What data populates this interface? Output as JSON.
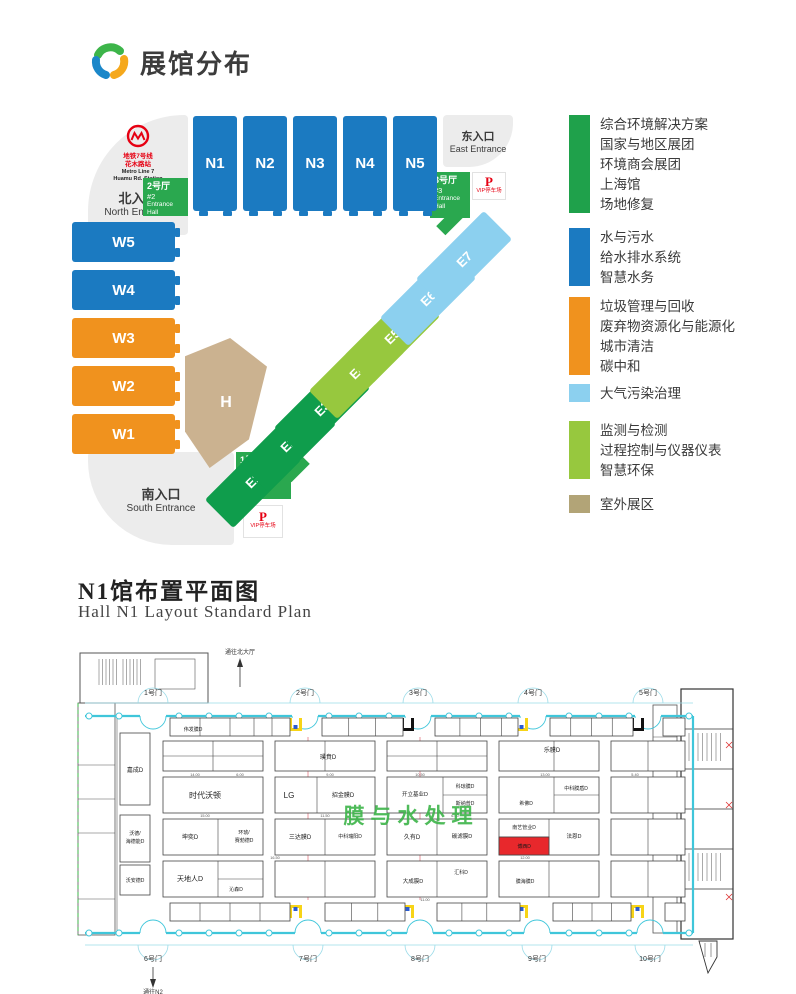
{
  "header": {
    "title": "展馆分布"
  },
  "site_map": {
    "north_entrance": {
      "metro_cn1": "地铁7号线",
      "metro_cn2": "花木路站",
      "metro_en1": "Metro Line 7",
      "metro_en2": "Huamu Rd. Station",
      "label_cn": "北入口",
      "label_en": "North Entrance"
    },
    "east_entrance": {
      "label_cn": "东入口",
      "label_en": "East Entrance"
    },
    "south_entrance": {
      "label_cn": "南入口",
      "label_en": "South Entrance"
    },
    "entrance_halls": [
      {
        "lines": [
          "2号厅",
          "#2",
          "Entrance Hall"
        ]
      },
      {
        "lines": [
          "3号厅",
          "#3",
          "Entrance Hall"
        ]
      },
      {
        "lines": [
          "1号厅",
          "#1",
          "Entrance Hall"
        ]
      }
    ],
    "parking": {
      "symbol": "P",
      "label": "VIP停车场"
    },
    "halls": [
      {
        "id": "N1",
        "x": 193,
        "y": 116,
        "w": 44,
        "h": 95,
        "color": "#1b7ac1",
        "stub": "b"
      },
      {
        "id": "N2",
        "x": 243,
        "y": 116,
        "w": 44,
        "h": 95,
        "color": "#1b7ac1",
        "stub": "b"
      },
      {
        "id": "N3",
        "x": 293,
        "y": 116,
        "w": 44,
        "h": 95,
        "color": "#1b7ac1",
        "stub": "b"
      },
      {
        "id": "N4",
        "x": 343,
        "y": 116,
        "w": 44,
        "h": 95,
        "color": "#1b7ac1",
        "stub": "b"
      },
      {
        "id": "N5",
        "x": 393,
        "y": 116,
        "w": 44,
        "h": 95,
        "color": "#1b7ac1",
        "stub": "b"
      },
      {
        "id": "W5",
        "x": 72,
        "y": 222,
        "w": 103,
        "h": 40,
        "color": "#1b7ac1",
        "stub": "r"
      },
      {
        "id": "W4",
        "x": 72,
        "y": 270,
        "w": 103,
        "h": 40,
        "color": "#1b7ac1",
        "stub": "r"
      },
      {
        "id": "W3",
        "x": 72,
        "y": 318,
        "w": 103,
        "h": 40,
        "color": "#f0921e",
        "stub": "r"
      },
      {
        "id": "W2",
        "x": 72,
        "y": 366,
        "w": 103,
        "h": 40,
        "color": "#f0921e",
        "stub": "r"
      },
      {
        "id": "W1",
        "x": 72,
        "y": 414,
        "w": 103,
        "h": 40,
        "color": "#f0921e",
        "stub": "r"
      },
      {
        "id": "E1",
        "cx": 253,
        "cy": 480,
        "rot": -45,
        "color": "#0f9d4c"
      },
      {
        "id": "E2",
        "cx": 288,
        "cy": 444,
        "rot": -45,
        "color": "#0f9d4c"
      },
      {
        "id": "E3",
        "cx": 322,
        "cy": 408,
        "rot": -45,
        "color": "#0f9d4c"
      },
      {
        "id": "E4",
        "cx": 357,
        "cy": 371,
        "rot": -45,
        "color": "#97c83e"
      },
      {
        "id": "E5",
        "cx": 392,
        "cy": 336,
        "rot": -45,
        "color": "#97c83e"
      },
      {
        "id": "E6",
        "cx": 428,
        "cy": 298,
        "rot": -45,
        "color": "#8cd0ef"
      },
      {
        "id": "E7",
        "cx": 464,
        "cy": 259,
        "rot": -45,
        "color": "#8cd0ef"
      },
      {
        "id": "H",
        "x": 185,
        "y": 338,
        "w": 82,
        "h": 130,
        "color": "#cbb290",
        "shape": "pent"
      }
    ]
  },
  "legend": {
    "groups": [
      {
        "color": "#1fa14b",
        "items": [
          "综合环境解决方案",
          "国家与地区展团",
          "环境商会展团",
          "上海馆",
          "场地修复"
        ]
      },
      {
        "color": "#1b7ac1",
        "items": [
          "水与污水",
          "给水排水系统",
          "智慧水务"
        ]
      },
      {
        "color": "#f0921e",
        "items": [
          "垃圾管理与回收",
          "废弃物资源化与能源化",
          "城市清洁",
          "碳中和"
        ]
      },
      {
        "color": "#8cd0ef",
        "items": [
          "大气污染治理"
        ]
      },
      {
        "color": "#97c83e",
        "items": [
          "监测与检测",
          "过程控制与仪器仪表",
          "智慧环保"
        ]
      },
      {
        "color": "#b2a477",
        "items": [
          "室外展区"
        ]
      }
    ]
  },
  "section": {
    "cn": "N1馆布置平面图",
    "en": "Hall N1 Layout Standard Plan"
  },
  "floor_plan": {
    "watermark": "膜与水处理",
    "to_north": "通往北大厅",
    "to_n2": "通往N2",
    "gates_top": [
      {
        "label": "1号门",
        "x": 78
      },
      {
        "label": "2号门",
        "x": 230
      },
      {
        "label": "3号门",
        "x": 343
      },
      {
        "label": "4号门",
        "x": 458
      },
      {
        "label": "5号门",
        "x": 573
      }
    ],
    "gates_bottom": [
      {
        "label": "6号门",
        "x": 78
      },
      {
        "label": "7号门",
        "x": 233
      },
      {
        "label": "8号门",
        "x": 345
      },
      {
        "label": "9号门",
        "x": 462
      },
      {
        "label": "10号门",
        "x": 575
      }
    ],
    "cells": [
      {
        "x": 95,
        "y": 73,
        "w": 120,
        "h": 18,
        "v": [
          0.25,
          0.5,
          0.7,
          0.85
        ]
      },
      {
        "x": 247,
        "y": 73,
        "w": 81,
        "h": 18,
        "v": [
          0.33,
          0.66
        ]
      },
      {
        "x": 360,
        "y": 73,
        "w": 83,
        "h": 18,
        "v": [
          0.3,
          0.55,
          0.8
        ]
      },
      {
        "x": 475,
        "y": 73,
        "w": 83,
        "h": 18,
        "v": [
          0.25,
          0.5,
          0.75
        ]
      },
      {
        "x": 588,
        "y": 73,
        "w": 22,
        "h": 18
      },
      {
        "x": 88,
        "y": 96,
        "w": 100,
        "h": 30,
        "v": [
          0.5
        ],
        "h2": [
          0.5
        ]
      },
      {
        "x": 200,
        "y": 96,
        "w": 100,
        "h": 30,
        "v": [
          0.5
        ]
      },
      {
        "x": 312,
        "y": 96,
        "w": 100,
        "h": 30,
        "v": [
          0.5
        ],
        "h2": [
          0.5
        ]
      },
      {
        "x": 424,
        "y": 96,
        "w": 100,
        "h": 30,
        "v": [
          0.55
        ]
      },
      {
        "x": 536,
        "y": 96,
        "w": 74,
        "h": 30,
        "v": [
          0.5
        ]
      },
      {
        "x": 88,
        "y": 132,
        "w": 100,
        "h": 36
      },
      {
        "x": 200,
        "y": 132,
        "w": 100,
        "h": 36,
        "v": [
          0.42
        ]
      },
      {
        "x": 312,
        "y": 132,
        "w": 100,
        "h": 36,
        "v": [
          0.56
        ],
        "hr": 1
      },
      {
        "x": 424,
        "y": 132,
        "w": 100,
        "h": 36,
        "v": [
          0.55
        ],
        "hr": 1
      },
      {
        "x": 536,
        "y": 132,
        "w": 74,
        "h": 36,
        "v": [
          0.5
        ]
      },
      {
        "x": 88,
        "y": 174,
        "w": 100,
        "h": 36,
        "v": [
          0.55
        ]
      },
      {
        "x": 200,
        "y": 174,
        "w": 100,
        "h": 36,
        "v": [
          0.5
        ]
      },
      {
        "x": 312,
        "y": 174,
        "w": 100,
        "h": 36,
        "v": [
          0.5
        ]
      },
      {
        "x": 424,
        "y": 174,
        "w": 100,
        "h": 36,
        "v": [
          0.5
        ],
        "hl": 1
      },
      {
        "x": 424,
        "y": 192,
        "w": 50,
        "h": 18,
        "fill": "#e8282c"
      },
      {
        "x": 536,
        "y": 174,
        "w": 74,
        "h": 36,
        "v": [
          0.5
        ]
      },
      {
        "x": 88,
        "y": 216,
        "w": 100,
        "h": 36,
        "v": [
          0.55
        ],
        "hr": 1
      },
      {
        "x": 200,
        "y": 216,
        "w": 100,
        "h": 36,
        "v": [
          0.5
        ]
      },
      {
        "x": 312,
        "y": 216,
        "w": 100,
        "h": 36,
        "v": [
          0.5
        ]
      },
      {
        "x": 424,
        "y": 216,
        "w": 100,
        "h": 36,
        "v": [
          0.5
        ]
      },
      {
        "x": 536,
        "y": 216,
        "w": 74,
        "h": 36,
        "v": [
          0.5
        ]
      },
      {
        "x": 95,
        "y": 258,
        "w": 120,
        "h": 18,
        "v": [
          0.25,
          0.5,
          0.75
        ]
      },
      {
        "x": 250,
        "y": 258,
        "w": 80,
        "h": 18,
        "v": [
          0.33,
          0.66
        ]
      },
      {
        "x": 362,
        "y": 258,
        "w": 83,
        "h": 18,
        "v": [
          0.3,
          0.6
        ]
      },
      {
        "x": 478,
        "y": 258,
        "w": 78,
        "h": 18,
        "v": [
          0.25,
          0.5,
          0.75
        ]
      },
      {
        "x": 590,
        "y": 258,
        "w": 20,
        "h": 18
      },
      {
        "x": 45,
        "y": 88,
        "w": 30,
        "h": 72
      },
      {
        "x": 45,
        "y": 170,
        "w": 30,
        "h": 47
      },
      {
        "x": 45,
        "y": 220,
        "w": 30,
        "h": 30
      }
    ],
    "labels": [
      {
        "t": "伟发膜D",
        "x": 118,
        "y": 86,
        "s": 5
      },
      {
        "t": "嘉成D",
        "x": 60,
        "y": 127,
        "s": 6
      },
      {
        "t": "沃德/",
        "x": 60,
        "y": 190,
        "s": 5
      },
      {
        "t": "海德能D",
        "x": 60,
        "y": 198,
        "s": 5
      },
      {
        "t": "沃安德D",
        "x": 60,
        "y": 237,
        "s": 5
      },
      {
        "t": "璞賁D",
        "x": 253,
        "y": 114,
        "s": 6
      },
      {
        "t": "乐膜D",
        "x": 477,
        "y": 107,
        "s": 6
      },
      {
        "t": "时代沃顿",
        "x": 130,
        "y": 153,
        "s": 8
      },
      {
        "t": "LG",
        "x": 214,
        "y": 153,
        "s": 8
      },
      {
        "t": "招金膜D",
        "x": 268,
        "y": 152,
        "s": 6
      },
      {
        "t": "开立基业D",
        "x": 340,
        "y": 151,
        "s": 5.5
      },
      {
        "t": "科琼膜D",
        "x": 390,
        "y": 143,
        "s": 5
      },
      {
        "t": "斯纳普D",
        "x": 390,
        "y": 160,
        "s": 5
      },
      {
        "t": "希佛D",
        "x": 451,
        "y": 160,
        "s": 5
      },
      {
        "t": "中科膜盾D",
        "x": 501,
        "y": 145,
        "s": 5
      },
      {
        "t": "坤奕D",
        "x": 115,
        "y": 194,
        "s": 6
      },
      {
        "t": "环琥/",
        "x": 169,
        "y": 189,
        "s": 5
      },
      {
        "t": "赛勃德D",
        "x": 169,
        "y": 197,
        "s": 5
      },
      {
        "t": "三达膜D",
        "x": 225,
        "y": 194,
        "s": 6
      },
      {
        "t": "中科瑞阳D",
        "x": 275,
        "y": 193,
        "s": 5
      },
      {
        "t": "久有D",
        "x": 337,
        "y": 194,
        "s": 6
      },
      {
        "t": "碳滤膜D",
        "x": 387,
        "y": 193,
        "s": 5.5
      },
      {
        "t": "南艺管业D",
        "x": 449,
        "y": 184,
        "s": 5
      },
      {
        "t": "博西D",
        "x": 449,
        "y": 203,
        "s": 5,
        "c": "#1a1a1a"
      },
      {
        "t": "法恩D",
        "x": 499,
        "y": 193,
        "s": 5.5
      },
      {
        "t": "天地人D",
        "x": 115,
        "y": 236,
        "s": 7
      },
      {
        "t": "沁森D",
        "x": 161,
        "y": 246,
        "s": 5
      },
      {
        "t": "大成膜D",
        "x": 338,
        "y": 238,
        "s": 5.5
      },
      {
        "t": "汇科D",
        "x": 386,
        "y": 229,
        "s": 5
      },
      {
        "t": "膜海膜D",
        "x": 450,
        "y": 238,
        "s": 5
      }
    ],
    "dims": [
      {
        "x": 120,
        "y": 131,
        "t": "14.00"
      },
      {
        "x": 165,
        "y": 131,
        "t": "6.00"
      },
      {
        "x": 255,
        "y": 131,
        "t": "9.00"
      },
      {
        "x": 345,
        "y": 131,
        "t": "10.50"
      },
      {
        "x": 470,
        "y": 131,
        "t": "13.00"
      },
      {
        "x": 560,
        "y": 131,
        "t": "5.40"
      },
      {
        "x": 130,
        "y": 172,
        "t": "15.00"
      },
      {
        "x": 250,
        "y": 172,
        "t": "11.50"
      },
      {
        "x": 380,
        "y": 172,
        "t": "6.00"
      },
      {
        "x": 200,
        "y": 214,
        "t": "16.50"
      },
      {
        "x": 450,
        "y": 214,
        "t": "12.00"
      },
      {
        "x": 350,
        "y": 256,
        "t": "11.00"
      }
    ]
  }
}
